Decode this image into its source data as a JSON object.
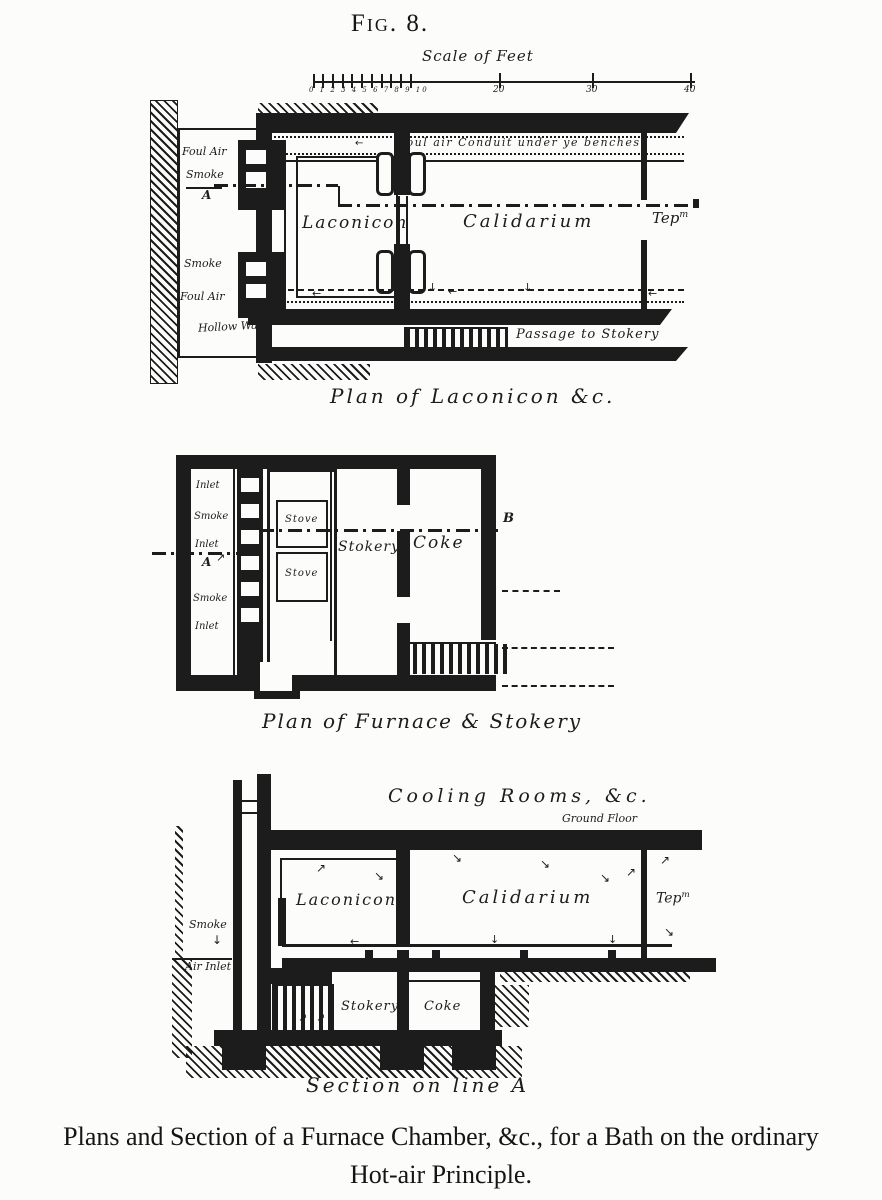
{
  "colors": {
    "ink": "#1c1c1c",
    "paper": "#fcfcfa"
  },
  "figure_title": "Fig. 8.",
  "scale": {
    "label": "Scale of Feet",
    "minor_numbers": "0 1 2 3 4 5 6 7 8 9 10",
    "major_numbers": [
      "20",
      "30",
      "40"
    ]
  },
  "plan_laconicon": {
    "caption": "Plan of Laconicon &c.",
    "labels": {
      "foul_air_top": "Foul Air",
      "smoke_top": "Smoke",
      "marker_a": "A",
      "smoke_bottom": "Smoke",
      "foul_air_bottom": "Foul Air",
      "hollow_wall": "Hollow Wall",
      "laconicon": "Laconicon",
      "calidarium": "Calidarium",
      "tepidarium_abbr": "Tep",
      "tepidarium_sup": "m",
      "conduit_note": "Foul air Conduit under ye benches",
      "passage": "Passage to Stokery"
    }
  },
  "plan_furnace": {
    "caption": "Plan of Furnace & Stokery",
    "labels": {
      "inlet_top": "Inlet",
      "smoke_top": "Smoke",
      "inlet_middle": "Inlet",
      "marker_a": "A",
      "smoke_bottom": "Smoke",
      "inlet_bottom": "Inlet",
      "stove_upper": "Stove",
      "stove_lower": "Stove",
      "stokery": "Stokery",
      "coke": "Coke",
      "marker_b": "B"
    }
  },
  "section": {
    "caption": "Section on line A",
    "labels": {
      "cooling_rooms": "Cooling Rooms, &c.",
      "ground_floor": "Ground Floor",
      "laconicon": "Laconicon",
      "calidarium": "Calidarium",
      "tepidarium_abbr": "Tep",
      "tepidarium_sup": "m",
      "smoke": "Smoke",
      "air_inlet": "Air Inlet",
      "stokery": "Stokery",
      "coke": "Coke"
    }
  },
  "footer_caption": {
    "line1": "Plans and Section of a Furnace Chamber, &c., for a Bath on the ordinary",
    "line2": "Hot-air Principle."
  },
  "icons": {
    "arrow_left": "←",
    "arrow_right": "→",
    "arrow_down": "↓",
    "arrow_up_right": "↗",
    "arrow_down_right": "↘"
  }
}
